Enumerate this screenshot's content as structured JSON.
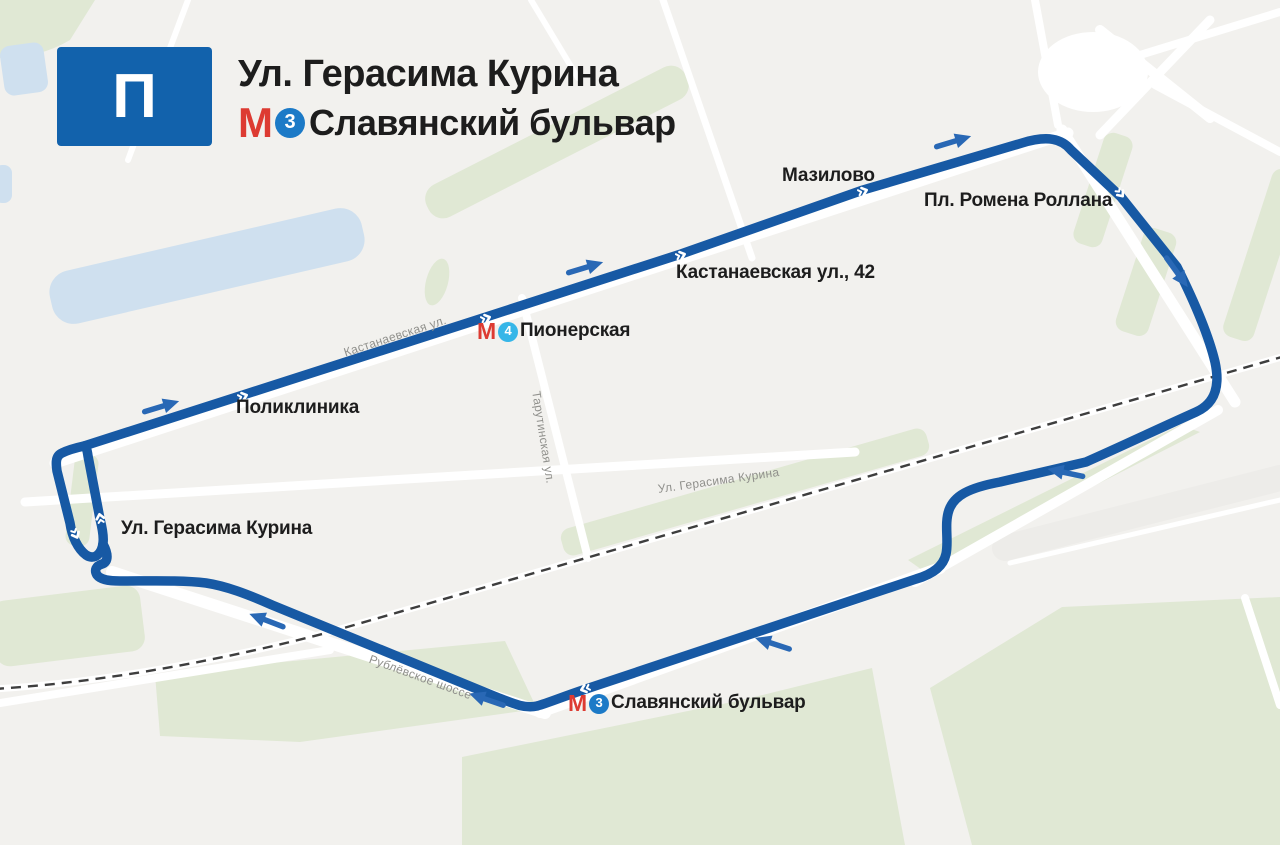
{
  "header": {
    "route_badge": "П",
    "title_line1": "Ул. Герасима Курина",
    "metro_logo": "М",
    "metro_line_number": "3",
    "title_line2": "Славянский бульвар"
  },
  "map": {
    "stops": [
      {
        "label": "Поликлиника"
      },
      {
        "metro_logo": "М",
        "metro_line_number": "4",
        "label": "Пионерская"
      },
      {
        "label": "Кастанаевская ул., 42"
      },
      {
        "label": "Мазилово"
      },
      {
        "label": "Пл. Ромена Роллана"
      },
      {
        "label": "Ул. Герасима Курина"
      },
      {
        "metro_logo": "М",
        "metro_line_number": "3",
        "label": "Славянский бульвар"
      }
    ],
    "street_labels": [
      {
        "label": "Кастанаевская ул."
      },
      {
        "label": "Тарутинская ул."
      },
      {
        "label": "Ул. Герасима Курина"
      },
      {
        "label": "Рублёвское шоссе"
      }
    ],
    "colors": {
      "route": "#1759A4",
      "arrow": "#2968B5",
      "badge": "#1262AC",
      "metro_red": "#DD3B32",
      "line3_circle": "#1C7AC7",
      "line4_circle": "#36B6E8",
      "park": "#E0E8D4",
      "water": "#CFE0EF",
      "background": "#F2F1EE"
    }
  }
}
